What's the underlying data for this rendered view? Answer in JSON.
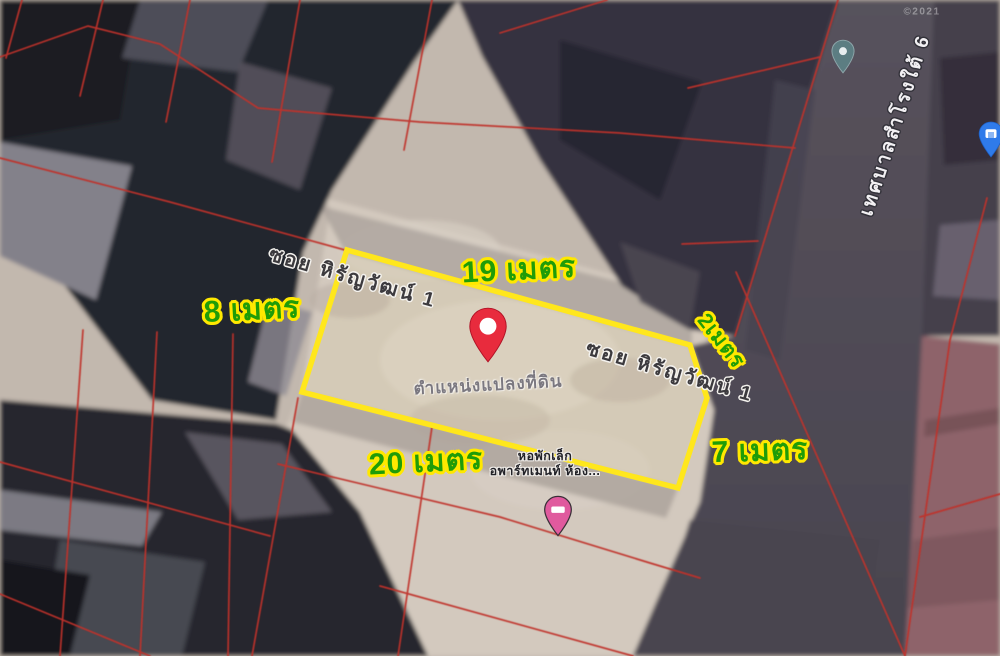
{
  "map": {
    "watermark": "©2021",
    "measurements": {
      "top": "19 เมตร",
      "left": "8 เมตร",
      "bottom": "20 เมตร",
      "right": "7 เมตร",
      "notch": "2เมตร"
    },
    "streets": {
      "soi_top": "ซอย หิรัญวัฒน์ 1",
      "soi_right": "ซอย หิรัญวัฒน์ 1",
      "road_right": "เทศบาลสำโรงใต้ 6"
    },
    "plot_label": "ตำแหน่งแปลงที่ดิน",
    "poi": {
      "line1": "หอพักเล็ก",
      "line2": "อพาร์ทเมนท์ ห้อง..."
    },
    "colors": {
      "plot_outline": "#ffe71c",
      "measure_text": "#1f9c08",
      "measure_halo": "#ffe800",
      "cadastral_line": "#c0322b",
      "pin_red": "#e82b3d",
      "pin_pink": "#e05a9e",
      "pin_teal": "#5c7d82",
      "pin_blue": "#2f7bea"
    }
  }
}
